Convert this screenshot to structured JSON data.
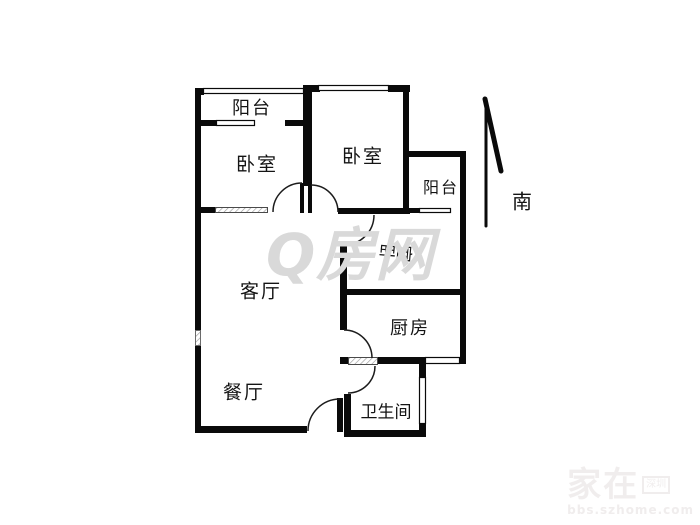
{
  "compass": {
    "south_label": "南"
  },
  "watermark": {
    "center": "Q房网",
    "corner_title": "家在",
    "corner_badge": "深圳",
    "corner_url": "bbs.szhome.com"
  },
  "rooms": {
    "balcony_top": {
      "label": "阳台"
    },
    "bedroom_left": {
      "label": "卧室"
    },
    "bedroom_middle": {
      "label": "卧室"
    },
    "balcony_right": {
      "label": "阳台"
    },
    "bedroom_right": {
      "label_parts": [
        "卧",
        "室"
      ]
    },
    "living_room": {
      "label": "客厅"
    },
    "kitchen": {
      "label": "厨房"
    },
    "dining_room": {
      "label": "餐厅"
    },
    "bathroom": {
      "label": "卫生间"
    }
  },
  "colors": {
    "wall": "#0a0a0a",
    "watermark_center": "#d9d9d9",
    "watermark_corner": "#f0eded"
  }
}
